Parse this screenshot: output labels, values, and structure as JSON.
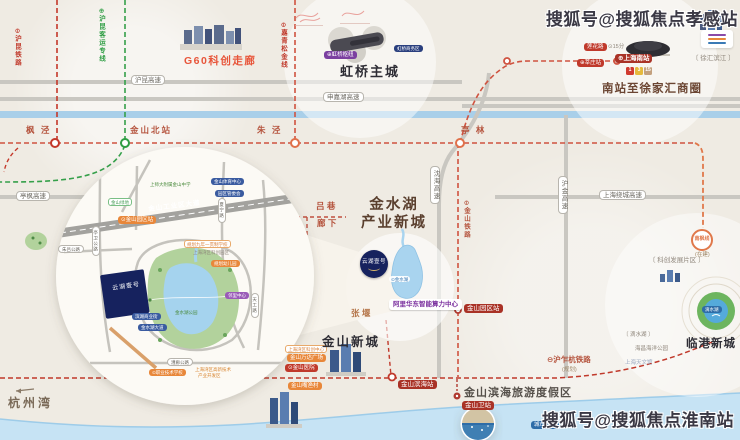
{
  "watermarks": {
    "top": "搜狐号@搜狐焦点孝感站",
    "bottom": "搜狐号@搜狐焦点淮南站"
  },
  "areas": {
    "g60": "G60科创走廊",
    "hongqiao": "虹桥主城",
    "nanzhan": "南站至徐家汇商圈",
    "jinshuihu1": "金水湖",
    "jinshuihu2": "产业新城",
    "jinshan": "金山新城",
    "lingang": "临港新城",
    "binhai": "金山滨海旅游度假区",
    "hangzhouwan": "杭州湾"
  },
  "project": {
    "name": "云湖壹号"
  },
  "colors": {
    "rail_red": "#c0392b",
    "rail_green": "#2f9e44",
    "rail_orange": "#e0784a",
    "highway_gray": "#c9c7c1",
    "water_blue": "#a9cfe9",
    "accent_orange": "#e8873a",
    "badge_darkred": "#a93226",
    "park_green": "#b2d29c",
    "parcel_navy": "#16225e"
  },
  "labels": [
    {
      "n": "hukun-railway-label",
      "t": "⊖沪昆铁路",
      "c": "rail-v red",
      "x": 13,
      "y": 28
    },
    {
      "n": "hukun-hsr-label",
      "t": "⊕沪昆客运专线",
      "c": "rail-v green",
      "x": 97,
      "y": 8
    },
    {
      "n": "jiaqingsongjin-line-label",
      "t": "⊖嘉青松金线",
      "c": "rail-v red",
      "x": 279,
      "y": 22
    },
    {
      "n": "jinshan-railway-label",
      "t": "⊖金山铁路",
      "c": "rail-v rust",
      "x": 462,
      "y": 200
    },
    {
      "n": "huzhahang-railway-label",
      "t": "⊖沪乍杭铁路",
      "c": "txt-rust s7",
      "x": 547,
      "y": 356
    },
    {
      "n": "huzhahang-planned-label",
      "t": "(规划)",
      "c": "txt-brown s5",
      "x": 562,
      "y": 367
    },
    {
      "n": "station-fengjing",
      "t": "枫 泾",
      "c": "txt-station",
      "x": 26,
      "y": 126
    },
    {
      "n": "station-jinshanbei",
      "t": "金山北站",
      "c": "txt-station",
      "x": 130,
      "y": 126
    },
    {
      "n": "station-zhujing",
      "t": "朱 泾",
      "c": "txt-station",
      "x": 257,
      "y": 126
    },
    {
      "n": "station-tinglin",
      "t": "亭 林",
      "c": "txt-station",
      "x": 461,
      "y": 126
    },
    {
      "n": "road-hukun-expwy",
      "t": "沪昆高速",
      "c": "roadpill s6",
      "x": 131,
      "y": 75
    },
    {
      "n": "road-shenjiahu-expwy",
      "t": "申嘉湖高速",
      "c": "roadpill s6",
      "x": 323,
      "y": 92
    },
    {
      "n": "road-tingfeng-expwy",
      "t": "亭枫高速",
      "c": "roadpill s6",
      "x": 16,
      "y": 191
    },
    {
      "n": "road-raocheng-expwy",
      "t": "上海绕城高速",
      "c": "roadpill s6",
      "x": 599,
      "y": 190
    },
    {
      "n": "road-shenhai-expwy",
      "t": "沈海高速",
      "c": "roadpill-v s6",
      "x": 430,
      "y": 166
    },
    {
      "n": "road-hujin-expwy",
      "t": "沪金高速",
      "c": "roadpill-v s6",
      "x": 558,
      "y": 176
    },
    {
      "n": "badge-lianhualu",
      "t": "莲花路",
      "c": "pill-red s5",
      "x": 584,
      "y": 43
    },
    {
      "n": "text-lianhualu-time",
      "t": "⊙15分",
      "c": "txt-gray s5",
      "x": 608,
      "y": 44
    },
    {
      "n": "badge-xinzhuang",
      "t": "⊕莘庄站",
      "c": "pill-red s5",
      "x": 577,
      "y": 59
    },
    {
      "n": "badge-shanghainanzhan",
      "t": "⊕上海南站",
      "c": "pill-darkred s6 bold",
      "x": 615,
      "y": 54
    },
    {
      "n": "text-xuhuibinjiang",
      "t": "〔 徐汇滨江 〕",
      "c": "txt-gray s6",
      "x": 692,
      "y": 55
    },
    {
      "n": "pill-hongqiao-hub",
      "t": "⊕虹桥枢纽",
      "c": "pill-purplebg s5",
      "x": 324,
      "y": 51
    },
    {
      "n": "pill-hongqiao-cbd",
      "t": "虹桥商务区",
      "c": "pill-navy s4",
      "x": 394,
      "y": 45
    },
    {
      "n": "text-lvxiang",
      "t": "吕 巷",
      "c": "txt-rust s8",
      "x": 316,
      "y": 202
    },
    {
      "n": "text-langxia",
      "t": "廊 下",
      "c": "txt-rust s8",
      "x": 317,
      "y": 219
    },
    {
      "n": "pill-jinshuihu-lake",
      "t": "⊙金水湖",
      "c": "pill-white s4",
      "x": 389,
      "y": 276
    },
    {
      "n": "box-ali-computing-center",
      "t": "阿里华东智能算力中心",
      "c": "box-purple s6",
      "x": 389,
      "y": 299
    },
    {
      "n": "badge-jinshan-yuanqu-station",
      "t": "金山园区站",
      "c": "pill-darkred s6",
      "x": 464,
      "y": 304
    },
    {
      "n": "text-zhangyan",
      "t": "张 堰",
      "c": "txt-tan s8",
      "x": 351,
      "y": 309
    },
    {
      "n": "ring-nanfeng-line",
      "t": "南枫线",
      "c": "ring-orange",
      "x": 691,
      "y": 229
    },
    {
      "n": "text-nanfeng-building",
      "t": "(在建)",
      "c": "txt-brown s5",
      "x": 695,
      "y": 252
    },
    {
      "n": "text-kechuang-area",
      "t": "〔 科创发展片区 〕",
      "c": "txt-gray s6",
      "x": 649,
      "y": 257
    },
    {
      "n": "pill-wanqu-kechuang",
      "t": "上海湾区科创中心",
      "c": "pill-orangeline s4",
      "x": 285,
      "y": 345
    },
    {
      "n": "pill-jinshan-wanda",
      "t": "金山万达广场",
      "c": "pill-orange s5",
      "x": 287,
      "y": 354
    },
    {
      "n": "pill-jinshan-hospital",
      "t": "⊙金山医院",
      "c": "pill-red s5",
      "x": 285,
      "y": 364
    },
    {
      "n": "pill-jinshanzui-village",
      "t": "金山嘴渔村",
      "c": "pill-orange s5",
      "x": 288,
      "y": 382
    },
    {
      "n": "badge-jinshan-binhai-station",
      "t": "金山滨海站",
      "c": "pill-darkred s6",
      "x": 398,
      "y": 380
    },
    {
      "n": "badge-jinshanwei-station",
      "t": "金山卫站",
      "c": "pill-darkred s6",
      "x": 462,
      "y": 401
    },
    {
      "n": "pill-city-beach",
      "t": "城市沙滩",
      "c": "pill-bluedark s5",
      "x": 531,
      "y": 421
    },
    {
      "n": "pill-dishui-lake",
      "t": "滴水湖",
      "c": "pill-bluedark s4",
      "x": 702,
      "y": 306
    },
    {
      "n": "text-dishuihu",
      "t": "〔 滴水湖 〕",
      "c": "txt-gray s5",
      "x": 623,
      "y": 332
    },
    {
      "n": "text-haichang-park",
      "t": "海昌海洋公园",
      "c": "txt-gray s5",
      "x": 635,
      "y": 346
    },
    {
      "n": "text-tianwenguan",
      "t": "上海天文馆",
      "c": "txt-faintblue s5",
      "x": 625,
      "y": 360
    },
    {
      "n": "roadname-gongyequ-avenue",
      "t": "金山工业区大道",
      "c": "roadname s6",
      "x": 148,
      "y": 206,
      "r": -7
    },
    {
      "n": "pill-yuanqu-station-inset",
      "t": "⊙金山园区站",
      "c": "pill-orange s5",
      "x": 118,
      "y": 216
    },
    {
      "n": "text-shisda-school",
      "t": "上师大附属金山中学",
      "c": "txt-green s4",
      "x": 150,
      "y": 182
    },
    {
      "n": "pill-sports-center",
      "t": "金山体育中心",
      "c": "pill-blue s4",
      "x": 211,
      "y": 178
    },
    {
      "n": "pill-guanweihui",
      "t": "园区管委会",
      "c": "pill-blue s4",
      "x": 215,
      "y": 190
    },
    {
      "n": "pill-jiunian-school",
      "t": "规划九年一贯制学校",
      "c": "pill-orangeline s4",
      "x": 184,
      "y": 240
    },
    {
      "n": "text-wanqu-park",
      "t": "上海湾区科创园区",
      "c": "txt-gray s4",
      "x": 193,
      "y": 250
    },
    {
      "n": "pill-kindergarten",
      "t": "规划幼儿园",
      "c": "pill-orange s4",
      "x": 211,
      "y": 260
    },
    {
      "n": "pill-linli-center",
      "t": "邻里中心",
      "c": "pill-purple s4",
      "x": 225,
      "y": 292
    },
    {
      "n": "text-jinshuihu-park",
      "t": "金水湖公园",
      "c": "txt-green s4",
      "x": 175,
      "y": 310
    },
    {
      "n": "pill-binhu-street",
      "t": "滨湖商业街",
      "c": "pill-blue s4",
      "x": 132,
      "y": 313
    },
    {
      "n": "pill-jinshuihu-avenue",
      "t": "金水湖大道",
      "c": "pill-blue s4",
      "x": 138,
      "y": 324
    },
    {
      "n": "pill-vocational-school",
      "t": "⊙职业技术学校",
      "c": "pill-orange s4",
      "x": 149,
      "y": 369
    },
    {
      "n": "text-gaoxin-line1",
      "t": "上海湾区高新技术",
      "c": "txt-orange2 s4",
      "x": 195,
      "y": 367
    },
    {
      "n": "text-gaoxin-line2",
      "t": "产业开发区",
      "c": "txt-orange2 s4",
      "x": 198,
      "y": 373
    },
    {
      "n": "roadpill-tingwei",
      "t": "亭卫公路",
      "c": "roadpill-v s4",
      "x": 92,
      "y": 226
    },
    {
      "n": "roadpill-xianing",
      "t": "夏宁路",
      "c": "roadpill-v s4",
      "x": 218,
      "y": 198
    },
    {
      "n": "roadpill-tiangong",
      "t": "天工路",
      "c": "roadpill-v s4",
      "x": 251,
      "y": 293
    },
    {
      "n": "roadpill-caolang",
      "t": "漕廊公路",
      "c": "roadpill s4",
      "x": 167,
      "y": 358
    },
    {
      "n": "roadpill-zhulv",
      "t": "朱吕公路",
      "c": "roadpill s4",
      "x": 58,
      "y": 245
    },
    {
      "n": "pill-jinshan-greenland",
      "t": "金山绿地",
      "c": "pill-greenline s4",
      "x": 108,
      "y": 198
    },
    {
      "n": "parcel-label",
      "t": "云湖壹号",
      "c": "parcel-text",
      "x": 104,
      "y": 287,
      "r": -8,
      "w": 44
    }
  ],
  "metro_badges": [
    {
      "n": "metro-line-1-badge",
      "t": "1",
      "c": "sq sq1",
      "x": 626,
      "y": 67
    },
    {
      "n": "metro-line-3-badge",
      "t": "3",
      "c": "sq sq3",
      "x": 635,
      "y": 67
    },
    {
      "n": "metro-line-15-badge",
      "t": "15",
      "c": "sq sq15",
      "x": 644,
      "y": 67
    }
  ]
}
